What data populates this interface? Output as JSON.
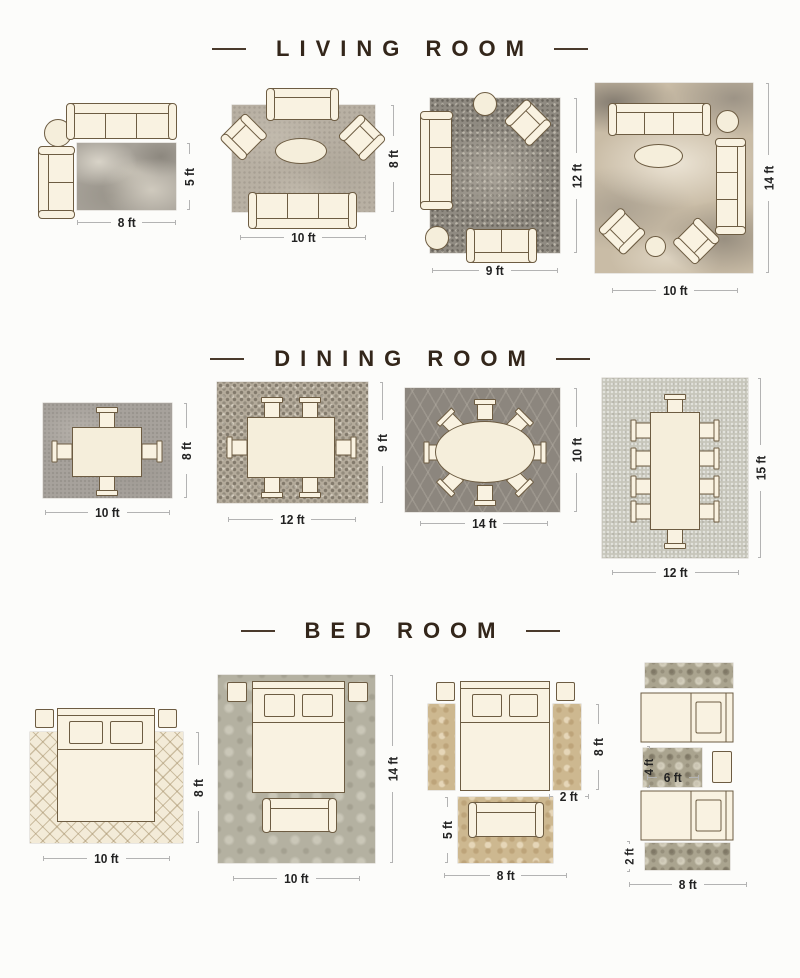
{
  "sections": {
    "living": {
      "title": "LIVING ROOM"
    },
    "dining": {
      "title": "DINING ROOM"
    },
    "bed": {
      "title": "BED ROOM"
    }
  },
  "living": {
    "l1": {
      "width": "8 ft",
      "height": "5 ft"
    },
    "l2": {
      "width": "10 ft",
      "height": "8 ft"
    },
    "l3": {
      "width": "9 ft",
      "height": "12 ft"
    },
    "l4": {
      "width": "10 ft",
      "height": "14 ft"
    }
  },
  "dining": {
    "d1": {
      "width": "10 ft",
      "height": "8 ft"
    },
    "d2": {
      "width": "12 ft",
      "height": "9 ft"
    },
    "d3": {
      "width": "14 ft",
      "height": "10 ft"
    },
    "d4": {
      "width": "12 ft",
      "height": "15 ft"
    }
  },
  "bed": {
    "b1": {
      "width": "10 ft",
      "height": "8 ft"
    },
    "b2": {
      "width": "10 ft",
      "height": "14 ft"
    },
    "b3": {
      "rug_width": "8 ft",
      "rug_height": "5 ft",
      "runner_width": "2 ft",
      "runner_height": "8 ft"
    },
    "b4": {
      "rug_width": "8 ft",
      "runner_height": "2 ft",
      "mid_width": "6 ft",
      "mid_height": "4 ft"
    }
  },
  "colors": {
    "title_text": "#33261a",
    "dimension_text": "#222222",
    "dimension_line": "#b3b3b3",
    "furniture_fill": "#f9f2e1",
    "furniture_outline": "#6d5c42"
  }
}
